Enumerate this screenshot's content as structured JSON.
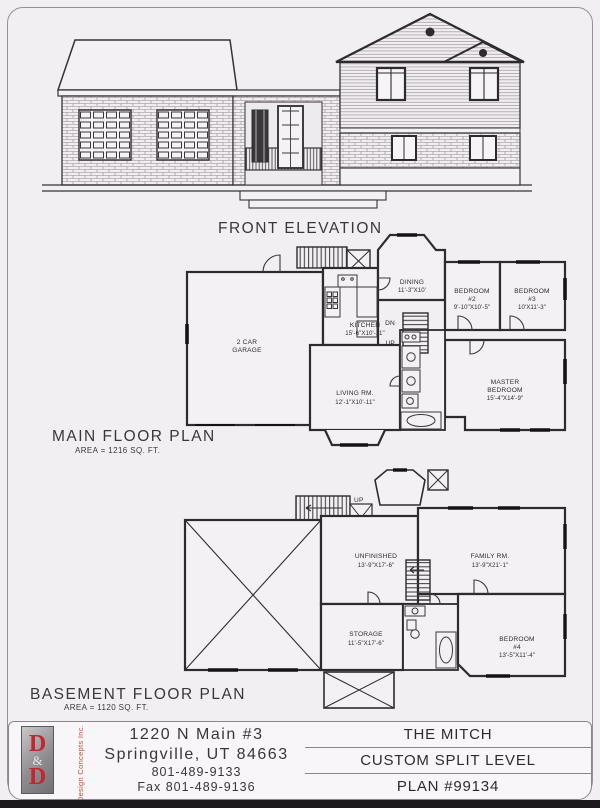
{
  "page": {
    "background": "#f2eff2",
    "ink": "#2e2b2f",
    "accent_red": "#c3262c",
    "logo_orange": "#c2512f"
  },
  "elevation": {
    "caption": "FRONT ELEVATION"
  },
  "main_floor": {
    "caption": "MAIN FLOOR PLAN",
    "area": "AREA = 1216 SQ. FT.",
    "garage_line1": "2 CAR",
    "garage_line2": "GARAGE",
    "kitchen_name": "KITCHEN",
    "kitchen_dims": "15'-6\"X10'-11\"",
    "dining_name": "DINING",
    "dining_dims": "11'-3\"X10'",
    "bedroom2_name": "BEDROOM",
    "bedroom2_num": "#2",
    "bedroom2_dims": "9'-10\"X10'-5\"",
    "bedroom3_name": "BEDROOM",
    "bedroom3_num": "#3",
    "bedroom3_dims": "10'X11'-3\"",
    "master_line1": "MASTER",
    "master_line2": "BEDROOM",
    "master_dims": "15'-4\"X14'-9\"",
    "living_name": "LIVING RM.",
    "living_dims": "12'-1\"X10'-11\"",
    "dn": "DN",
    "up": "UP"
  },
  "basement": {
    "caption": "BASEMENT FLOOR PLAN",
    "area": "AREA = 1120 SQ. FT.",
    "unfinished_name": "UNFINISHED",
    "unfinished_dims": "13'-9\"X17'-6\"",
    "family_name": "FAMILY RM.",
    "family_dims": "13'-9\"X21'-1\"",
    "storage_name": "STORAGE",
    "storage_dims": "11'-5\"X17'-6\"",
    "bedroom4_name": "BEDROOM",
    "bedroom4_num": "#4",
    "bedroom4_dims": "13'-5\"X11'-4\"",
    "up": "UP"
  },
  "title_block": {
    "logo_letter_top": "D",
    "logo_amp": "&",
    "logo_letter_bottom": "D",
    "logo_company": "Design Concepts Inc.",
    "address_line1": "1220 N Main #3",
    "address_line2": "Springville, UT 84663",
    "phone": "801-489-9133",
    "fax": "Fax 801-489-9136",
    "plan_name": "THE MITCH",
    "plan_style": "CUSTOM SPLIT LEVEL",
    "plan_number": "PLAN #99134"
  }
}
